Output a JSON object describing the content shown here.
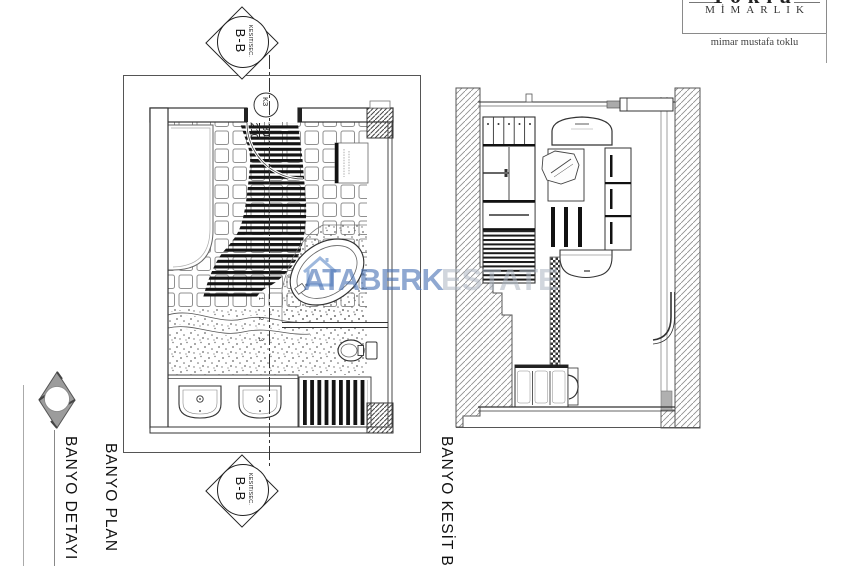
{
  "logo": {
    "brand": "Toklu",
    "firm": "MİMARLIK",
    "tagline": "mimar mustafa toklu"
  },
  "markers": {
    "section_small": "KESIT/SEC.",
    "section_large": "B-B",
    "detail_label": "BANYO DETAYI"
  },
  "plan": {
    "title": "BANYO PLAN",
    "door_tag": "K3",
    "door_width": "80",
    "door_height": "210",
    "dimension_marks": [
      "1",
      "2",
      "3"
    ]
  },
  "section_view": {
    "title": "BANYO KESİT B-B"
  },
  "watermark": {
    "primary": "ATABERK",
    "secondary": "ESTATE",
    "primary_color": "#4a72b5",
    "secondary_color": "#acb4c1"
  }
}
